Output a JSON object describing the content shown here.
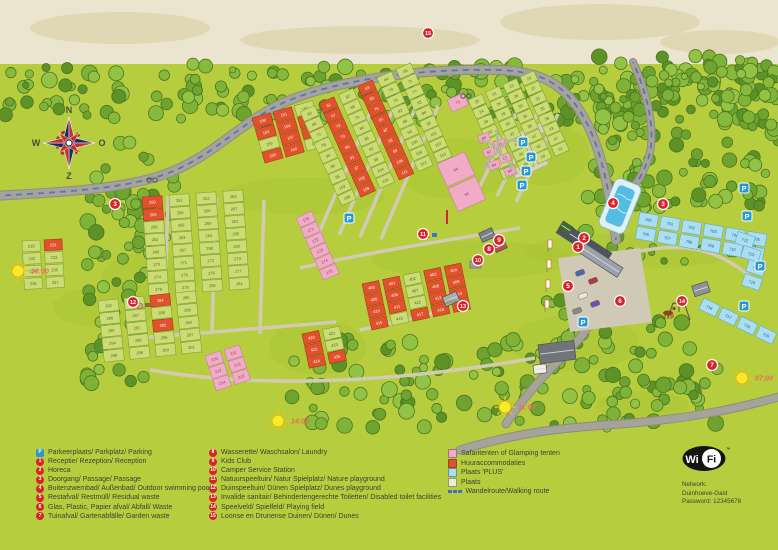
{
  "legend": {
    "col1": [
      {
        "icon": "P",
        "label": "Parkeerplaats/ Parkplatz/ Parking"
      },
      {
        "icon": "1",
        "label": "Receptie/ Rezeption/ Reception"
      },
      {
        "icon": "2",
        "label": "Horeca"
      },
      {
        "icon": "3",
        "label": "Doorgang/ Passage/ Passage"
      },
      {
        "icon": "4",
        "label": "Buitenzwembad/ Außenbad/ Outdoor swimming pool"
      },
      {
        "icon": "5",
        "label": "Restafval/ Restmüll/ Residual waste"
      },
      {
        "icon": "6",
        "label": "Glas, Plastic, Papier afval/ Abfall/ Waste"
      },
      {
        "icon": "7",
        "label": "Tuinafval/ Gartenabfälle/ Garden waste"
      }
    ],
    "col2": [
      {
        "icon": "8",
        "label": "Wasserette/ Waschsalon/ Laundry"
      },
      {
        "icon": "9",
        "label": "Kids Club"
      },
      {
        "icon": "10",
        "label": "Camper Service Station"
      },
      {
        "icon": "11",
        "label": "Natuurspeeltuin/ Natur Spielplatz/ Nature playground"
      },
      {
        "icon": "12",
        "label": "Duinspeeltuin/ Dünen Spielplatz/ Dunes playground"
      },
      {
        "icon": "13",
        "label": "Invalide sanitair/ Behindertengerechte Toiletten/ Disabled toilet facilities"
      },
      {
        "icon": "14",
        "label": "Speelveld/ Spielfeld/ Playing field"
      },
      {
        "icon": "15",
        "label": "Loonse en Drunense Duinen/ Dünen/ Dunes"
      }
    ],
    "col3": [
      {
        "swatch": "safari",
        "color": "#f1abc7",
        "label": "Safaritenten of Glamping tenten"
      },
      {
        "swatch": "huur",
        "color": "#e0512c",
        "label": "Huuraccommodaties"
      },
      {
        "swatch": "plus",
        "color": "#a9def3",
        "label": "Plaats 'PLUS'"
      },
      {
        "swatch": "plaats",
        "color": "#e9efcf",
        "label": "Plaats"
      },
      {
        "swatch": "route",
        "color": "#4a6fae",
        "label": "Wandelroute/Walking route"
      }
    ]
  },
  "wifi": {
    "logo_wi": "Wi",
    "logo_fi": "Fi",
    "tm": "™",
    "lines": [
      "Network:",
      "Duinhoeve-Gast",
      "Password: 12345678"
    ]
  },
  "map": {
    "compass": {
      "north": "N",
      "east": "O",
      "south": "Z",
      "west": "W",
      "x": 69,
      "y": 143
    },
    "street_label": {
      "text": "Eiken",
      "x": 452,
      "y": 303,
      "rot": -12
    },
    "suns": [
      {
        "time": "18:00",
        "x": 18,
        "y": 271
      },
      {
        "time": "14:00",
        "x": 278,
        "y": 421
      },
      {
        "time": "11:00",
        "x": 505,
        "y": 407
      },
      {
        "time": "07:00",
        "x": 742,
        "y": 378
      }
    ],
    "markers": [
      {
        "n": "15",
        "x": 428,
        "y": 33,
        "name": "dunes"
      },
      {
        "n": "3",
        "x": 115,
        "y": 204,
        "name": "passage-west"
      },
      {
        "n": "12",
        "x": 133,
        "y": 302,
        "name": "dunes-playground"
      },
      {
        "n": "11",
        "x": 423,
        "y": 234,
        "name": "nature-playground"
      },
      {
        "n": "9",
        "x": 499,
        "y": 240,
        "name": "kids-club"
      },
      {
        "n": "8",
        "x": 489,
        "y": 249,
        "name": "laundry"
      },
      {
        "n": "10",
        "x": 478,
        "y": 260,
        "name": "camper-service-station"
      },
      {
        "n": "13",
        "x": 463,
        "y": 306,
        "name": "disabled-toilet"
      },
      {
        "n": "4",
        "x": 613,
        "y": 203,
        "name": "outdoor-pool"
      },
      {
        "n": "3",
        "x": 663,
        "y": 204,
        "name": "passage-east"
      },
      {
        "n": "2",
        "x": 584,
        "y": 238,
        "name": "horeca"
      },
      {
        "n": "1",
        "x": 578,
        "y": 247,
        "name": "reception"
      },
      {
        "n": "5",
        "x": 568,
        "y": 286,
        "name": "residual-waste"
      },
      {
        "n": "6",
        "x": 620,
        "y": 301,
        "name": "glass-plastic-paper-waste"
      },
      {
        "n": "14",
        "x": 682,
        "y": 301,
        "name": "playing-field"
      },
      {
        "n": "7",
        "x": 712,
        "y": 365,
        "name": "garden-waste"
      }
    ],
    "parkings": [
      {
        "x": 523,
        "y": 142
      },
      {
        "x": 531,
        "y": 157
      },
      {
        "x": 526,
        "y": 171
      },
      {
        "x": 522,
        "y": 185
      },
      {
        "x": 349,
        "y": 218
      },
      {
        "x": 583,
        "y": 322
      },
      {
        "x": 744,
        "y": 188
      },
      {
        "x": 747,
        "y": 216
      },
      {
        "x": 760,
        "y": 266
      },
      {
        "x": 744,
        "y": 306
      }
    ],
    "plot_colors": {
      "g": {
        "fill": "#cbdc74",
        "stroke": "#82a038",
        "text": "#55642a"
      },
      "h": {
        "fill": "#e0512c",
        "stroke": "#a83a1e",
        "text": "#ffffff"
      },
      "s": {
        "fill": "#f1abc7",
        "stroke": "#c480a2",
        "text": "#7d3f60"
      },
      "b": {
        "fill": "#a9def3",
        "stroke": "#64a8cc",
        "text": "#1f5c7d"
      }
    },
    "blocks": [
      {
        "id": "west-upper",
        "x": 142,
        "y": 197,
        "rot": -4,
        "cols": 4,
        "rows": 8,
        "cw": 20,
        "ch": 11.5,
        "gx": 7,
        "gy": 1,
        "num_start": 250,
        "types": "hggghggggggggggggggggggggggggggg"
      },
      {
        "id": "west-lower",
        "x": 98,
        "y": 301,
        "rot": -6,
        "cols": 4,
        "rows": 5,
        "cw": 20,
        "ch": 11.5,
        "gx": 6,
        "gy": 1,
        "num_start": 282,
        "types": "gghggggggghggggggggg"
      },
      {
        "id": "far-west",
        "x": 22,
        "y": 241,
        "rot": -3,
        "cols": 2,
        "rows": 4,
        "cw": 18,
        "ch": 11,
        "gx": 4,
        "gy": 1.5,
        "num_start": 230,
        "types": "ghgggggg"
      },
      {
        "id": "northwest-huur",
        "x": 252,
        "y": 118,
        "rot": -16,
        "cols": 3,
        "rows": 4,
        "cw": 19,
        "ch": 11,
        "gx": 3,
        "gy": 1,
        "num_start": 150,
        "types": "hhghhhghhhhg"
      },
      {
        "id": "central",
        "x": 300,
        "y": 112,
        "rot": -24,
        "cols": 6,
        "rows": 9,
        "cw": 16,
        "ch": 10.5,
        "gx": 5,
        "gy": 1,
        "num_start": 60,
        "types": "ghghggghghggghghggghghggghghggghghggghghggghghggghghgg"
      },
      {
        "id": "central-safari-row",
        "x": 296,
        "y": 218,
        "rot": -24,
        "cols": 1,
        "rows": 6,
        "cw": 17,
        "ch": 10.5,
        "gx": 0,
        "gy": 1,
        "num_start": 170,
        "types": "ssssss"
      },
      {
        "id": "east-central",
        "x": 468,
        "y": 100,
        "rot": -24,
        "cols": 4,
        "rows": 8,
        "cw": 15,
        "ch": 10,
        "gx": 4,
        "gy": 1,
        "num_start": 20,
        "types": "gggggggggggggggggggggggggggggggg"
      },
      {
        "id": "safari-71",
        "x": 447,
        "y": 100,
        "rot": -24,
        "cols": 1,
        "rows": 1,
        "cw": 18,
        "ch": 13,
        "gx": 0,
        "gy": 0,
        "num_start": 71,
        "types": "s"
      },
      {
        "id": "big-safari",
        "x": 437,
        "y": 164,
        "rot": -24,
        "cols": 1,
        "rows": 2,
        "cw": 30,
        "ch": 25,
        "gx": 0,
        "gy": 2,
        "num_start": 64,
        "types": "ss"
      },
      {
        "id": "south-huur",
        "x": 362,
        "y": 284,
        "rot": -12,
        "cols": 5,
        "rows": 4,
        "cw": 17,
        "ch": 11,
        "gx": 4,
        "gy": 1,
        "num_start": 400,
        "types": "hhghhhhghhhhghhhghhh"
      },
      {
        "id": "south-huur-2",
        "x": 302,
        "y": 334,
        "rot": -12,
        "cols": 2,
        "rows": 3,
        "cw": 17,
        "ch": 11,
        "gx": 4,
        "gy": 1,
        "num_start": 420,
        "types": "hghghh"
      },
      {
        "id": "southwest-safari",
        "x": 205,
        "y": 356,
        "rot": -18,
        "cols": 2,
        "rows": 3,
        "cw": 16,
        "ch": 11.5,
        "gx": 4,
        "gy": 1,
        "num_start": 210,
        "types": "ssssss"
      },
      {
        "id": "plus-north",
        "x": 640,
        "y": 212,
        "rot": 10,
        "cols": 6,
        "rows": 2,
        "cw": 19,
        "ch": 12.5,
        "gx": 3,
        "gy": 2,
        "num_start": 700,
        "types": "bbbbbbbbbbbb"
      },
      {
        "id": "plus-southeast",
        "x": 704,
        "y": 298,
        "rot": 26,
        "cols": 4,
        "rows": 1,
        "cw": 18,
        "ch": 12,
        "gx": 3,
        "gy": 0,
        "num_start": 716,
        "types": "bbbb"
      }
    ],
    "free_cells": [
      {
        "id": "plus-east",
        "type": "b",
        "rot": 18,
        "cw": 18,
        "ch": 12,
        "cells": [
          {
            "n": 712,
            "x": 745,
            "y": 240
          },
          {
            "n": 713,
            "x": 751,
            "y": 254
          },
          {
            "n": 714,
            "x": 756,
            "y": 268
          },
          {
            "n": 715,
            "x": 752,
            "y": 282
          }
        ]
      },
      {
        "id": "glamping-north",
        "type": "s",
        "rot": -20,
        "cw": 11,
        "ch": 8,
        "cells": [
          {
            "n": 80,
            "x": 484,
            "y": 138
          },
          {
            "n": 81,
            "x": 500,
            "y": 144
          },
          {
            "n": 82,
            "x": 489,
            "y": 152
          },
          {
            "n": 83,
            "x": 505,
            "y": 158
          },
          {
            "n": 84,
            "x": 494,
            "y": 165
          },
          {
            "n": 85,
            "x": 510,
            "y": 171
          }
        ]
      }
    ]
  }
}
